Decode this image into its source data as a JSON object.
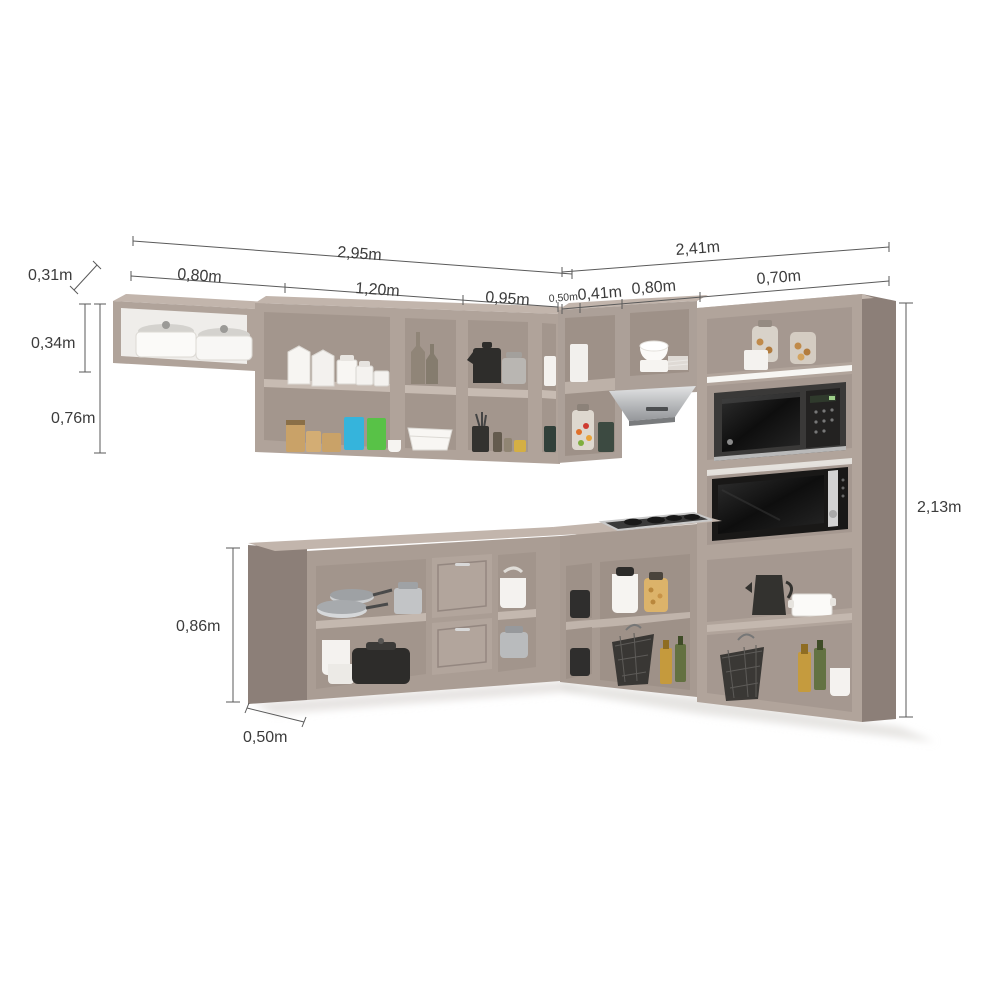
{
  "diagram": {
    "subject": "l-shaped-kitchen-cabinet-set-with-dimensions",
    "background": "#ffffff"
  },
  "colors": {
    "cabinet_front": "#b0a39a",
    "cabinet_front_light": "#c2b5ac",
    "cabinet_side_dark": "#8c7f78",
    "cabinet_interior": "#a3968d",
    "shelf_edge": "#c7bbb2",
    "appliance_dark": "#1c1b1a",
    "steel": "#c6c7c8",
    "white_item": "#f6f4f1",
    "dimension_line": "#5a5a5a",
    "dimension_text": "#3c3c3c",
    "accent_blue_canister": "#35b4dc",
    "accent_green_canister": "#58c247"
  },
  "dimensions": {
    "upper_run_left": {
      "total": "2,95m",
      "segments": [
        "0,80m",
        "1,20m",
        "0,95m"
      ]
    },
    "upper_run_right": {
      "total": "2,41m",
      "segments": [
        "0,50m",
        "0,41m",
        "0,80m",
        "0,70m"
      ]
    },
    "upper_depth": "0,31m",
    "upper_small_cabinet_height": "0,34m",
    "upper_cabinet_height": "0,76m",
    "tall_cabinet_height": "2,13m",
    "base_cabinet_height": "0,86m",
    "base_depth": "0,50m"
  }
}
